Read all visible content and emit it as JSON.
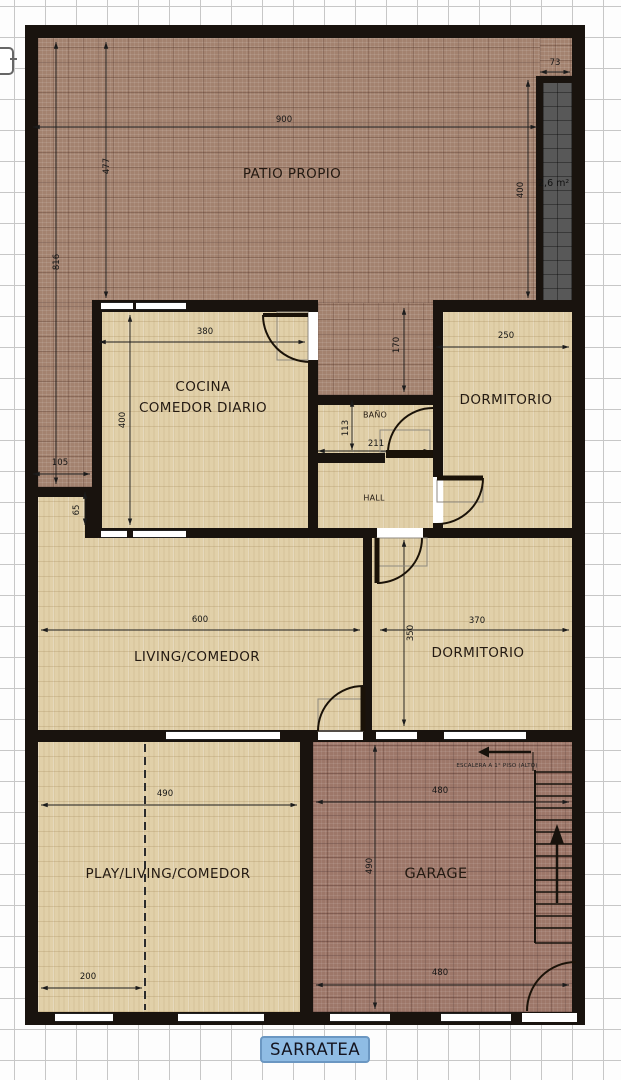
{
  "street_label": "SARRATEA",
  "rooms": {
    "patio": "PATIO PROPIO",
    "cocina_line1": "COCINA",
    "cocina_line2": "COMEDOR DIARIO",
    "banio": "BAÑO",
    "dorm1": "DORMITORIO",
    "hall": "HALL",
    "living": "LIVING/COMEDOR",
    "dorm2": "DORMITORIO",
    "play": "PLAY/LIVING/COMEDOR",
    "garage": "GARAGE"
  },
  "annotations": {
    "shaft_area": "2,6 m²",
    "stairs_note": "ESCALERA A 1° PISO (ALTO)"
  },
  "dims": {
    "patio_width": "900",
    "patio_depth": "477",
    "left_side_depth": "816",
    "shaft_width": "73",
    "shaft_height": "400",
    "patio_left_width": "105",
    "step_height": "65",
    "patio_mid_depth": "170",
    "cocina_width": "380",
    "cocina_depth": "400",
    "banio_depth": "113",
    "banio_width": "211",
    "dorm1_width": "250",
    "living_width": "600",
    "dorm2_width": "370",
    "dorm2_depth": "350",
    "play_width": "490",
    "play_offset": "200",
    "garage_width_top": "480",
    "garage_depth": "490",
    "garage_width_bottom": "480"
  },
  "colors": {
    "wall": "#19130e",
    "patio_floor": "#a3826f",
    "garage_floor": "#9d7769",
    "interior_floor": "#e1d0a9",
    "shaft": "#585858",
    "street_badge_bg": "#8fbce4",
    "street_badge_border": "#6b97c2",
    "dimension_line": "#1c1c1c"
  }
}
